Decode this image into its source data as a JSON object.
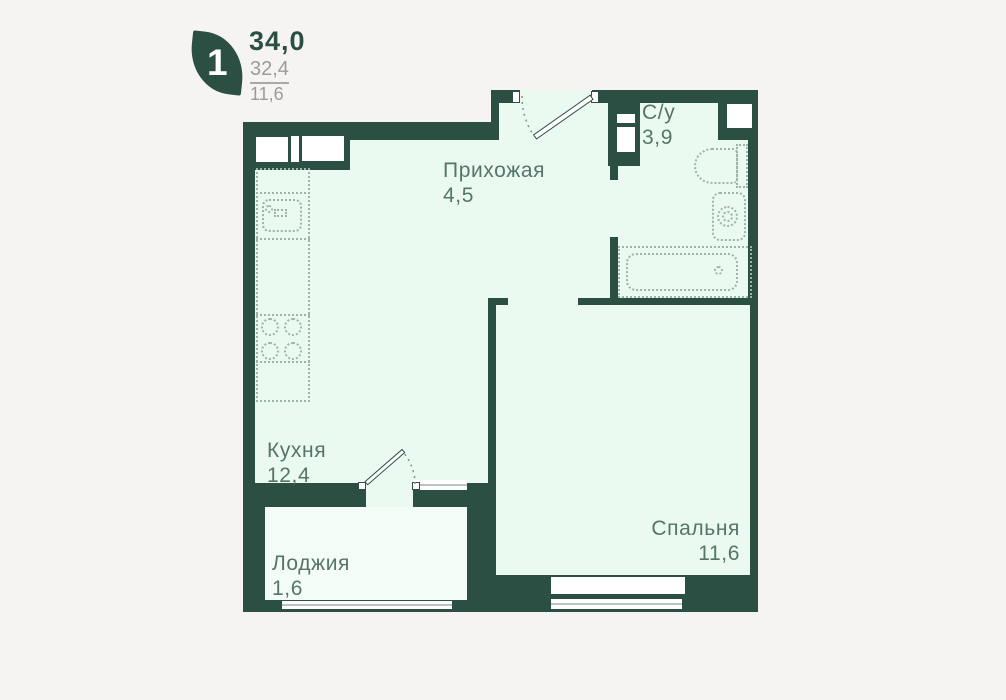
{
  "header": {
    "room_count": "1",
    "area_total": "34,0",
    "area_living": "32,4",
    "area_kitchen": "11,6"
  },
  "rooms": [
    {
      "key": "hallway",
      "label": "Прихожая",
      "area": "4,5"
    },
    {
      "key": "bathroom",
      "label": "С/у",
      "area": "3,9"
    },
    {
      "key": "kitchen",
      "label": "Кухня",
      "area": "12,4"
    },
    {
      "key": "loggia",
      "label": "Лоджия",
      "area": "1,6"
    },
    {
      "key": "bedroom",
      "label": "Спальня",
      "area": "11,6"
    }
  ],
  "fixtures": [
    "kitchen-counter",
    "kitchen-sink",
    "stove-burners",
    "toilet",
    "washing-machine",
    "bathtub"
  ],
  "colors": {
    "wall": "#2c4f44",
    "room_fill": "#eafaf1",
    "loggia_fill": "#f3fcf7",
    "page_background": "#f5f4f2",
    "fixture_dotted": "#9db5a9",
    "label_text": "#567568",
    "secondary_text": "#9b9b9b"
  }
}
